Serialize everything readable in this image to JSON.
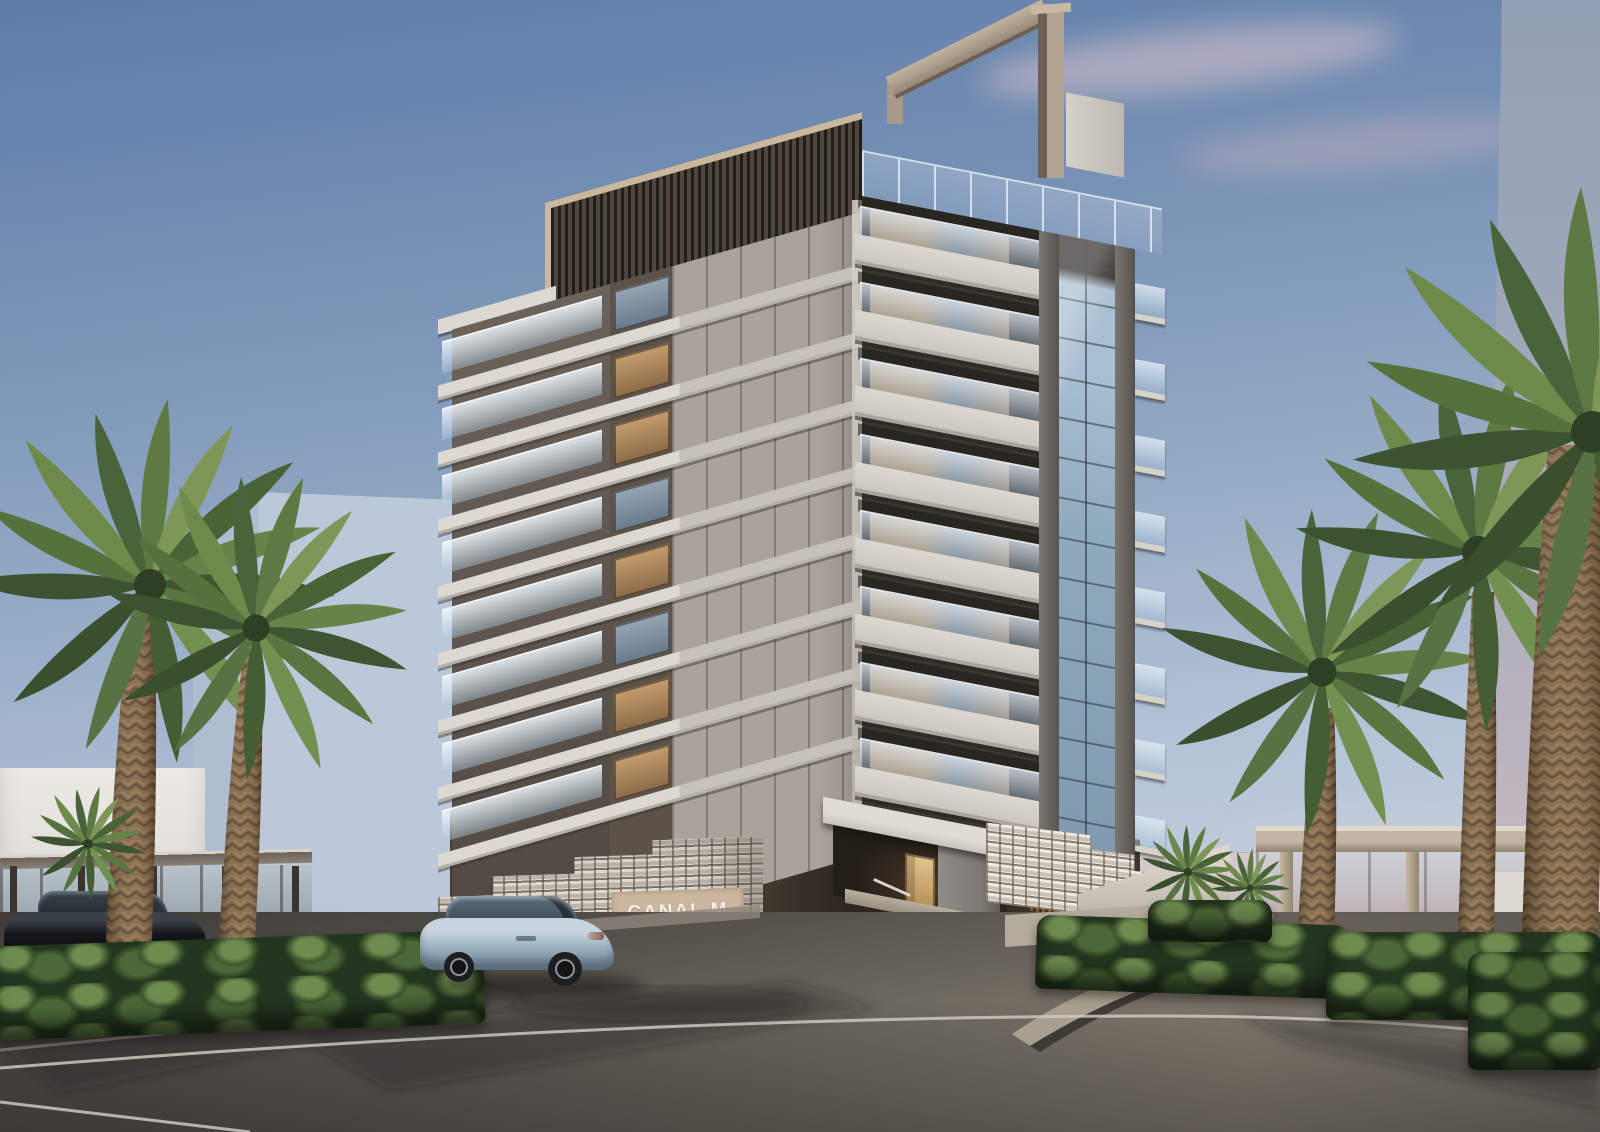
{
  "scene": {
    "category": "architectural-exterior-rendering",
    "setting": "Luxury residential tower at dusk with palm-lined driveway and waterfront promenade",
    "signage": {
      "project_name": "CANAL M"
    },
    "objects": [
      "ten-storey residential tower with stacked glass-railed balconies",
      "dark louvered rooftop parapet with sand-colored coping",
      "rooftop portal frame",
      "full-height glazed curtain-wall strip",
      "white perforated breeze-block entry walls",
      "project sign panel",
      "entry canopy with warm-lit lobby door",
      "stepped blue water feature",
      "date palm trees",
      "clipped green hedges",
      "asphalt driveway with white lane markings and stone curbs",
      "silver-blue luxury sedan",
      "black sedan",
      "glass pavilions",
      "pale distant towers in haze",
      "pink dusk clouds"
    ],
    "palette": {
      "sky-top": "#5d7ba8",
      "sky-mid": "#93a9c4",
      "sky-low": "#c6d1e0",
      "horizon-pink": "#e6c9cd",
      "sea-pink": "#d5c9cc",
      "ghost-blue": "#95a1b4",
      "facade-slab": "#ddd9d2",
      "glass-blue": "#7d98ac",
      "coping-sand": "#c9b79e",
      "portal-beige": "#b3a492",
      "podium-dark": "#3f372f",
      "breeze-white": "#ded8cf",
      "sign-bg": "#c7b29c",
      "sign-text": "#f5f1ea",
      "water-blue": "#7fb3cb",
      "basin-white": "#e6e2da",
      "hedge-dark": "#243620",
      "hedge-light": "#6f8c50",
      "trunk-brown": "#7b5d3c",
      "road-light": "#7d766c",
      "lane-white": "#ccc8c0",
      "curb-light": "#a89f90",
      "pavilion-beige": "#c3b6a4",
      "car-black": "#15171a",
      "car-blue": "#9db2c1"
    }
  }
}
